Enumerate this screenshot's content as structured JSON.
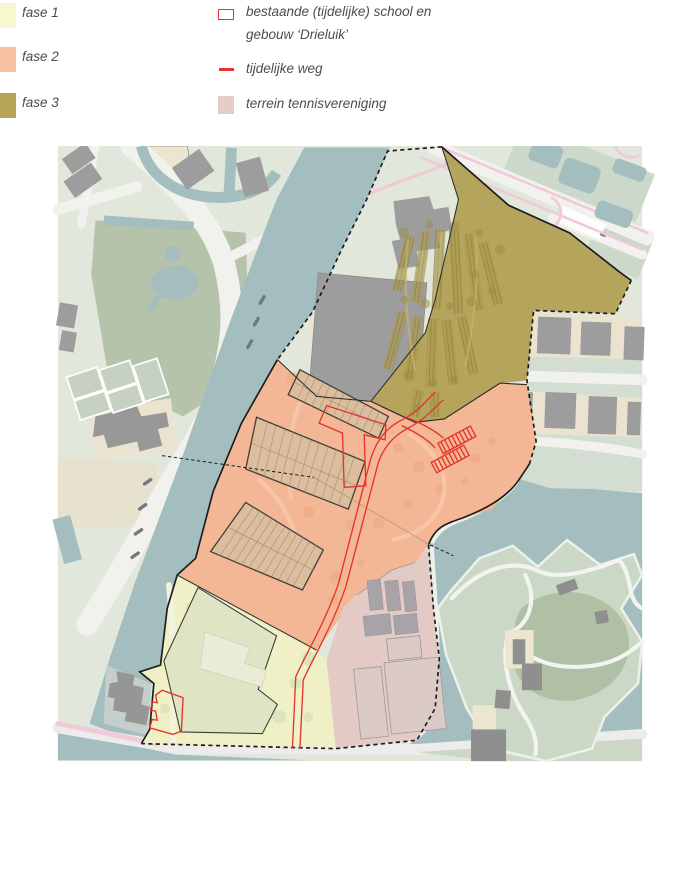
{
  "legend": {
    "items": [
      {
        "label": "fase 1",
        "color": "#f8f8cf"
      },
      {
        "label": "fase 2",
        "color": "#f7c3a3"
      },
      {
        "label": "fase 3",
        "color": "#b7a355"
      }
    ],
    "symbols": [
      {
        "label_line1": "bestaande (tijdelijke) school en",
        "label_line2": "gebouw ‘Drieluik’",
        "type": "red-outline-box",
        "color": "#e4342a"
      },
      {
        "label": "tijdelijke weg",
        "type": "red-line",
        "color": "#e4342a"
      },
      {
        "label": "terrein tennisvereniging",
        "type": "swatch",
        "color": "#e5cdc8"
      }
    ]
  },
  "map": {
    "colors": {
      "fase1_area": "#eff0c6",
      "fase2_area": "#f4b795",
      "fase3_area": "#b5a45c",
      "tennis_area": "#e3cac4",
      "red": "#e4342a",
      "water": "#a4bec0",
      "park_green": "#b4c3aa",
      "base_green": "#e1e7db",
      "building_gray": "#9d9d9d",
      "road_white": "#f1f2ee",
      "housing_block": "#dcbd9e",
      "boundary_black": "#1c1c1c",
      "pink_path": "#f2ccd8",
      "beige": "#e9e3d2"
    }
  }
}
